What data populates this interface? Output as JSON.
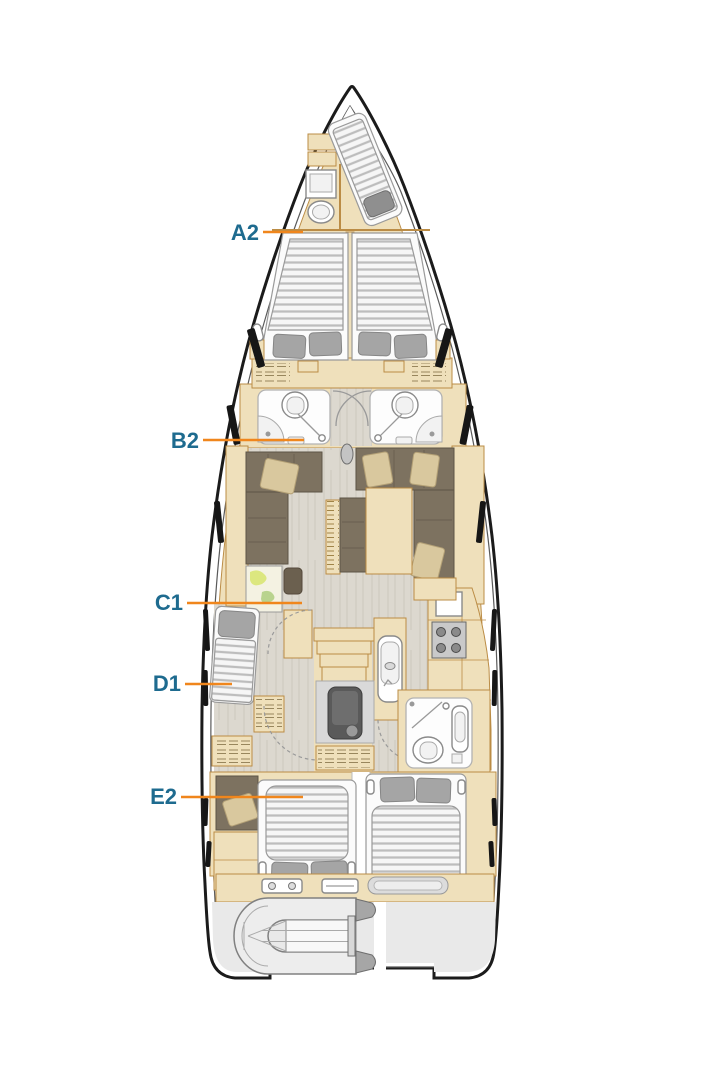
{
  "plan_labels": [
    {
      "text": "A2",
      "points_to": "bow-crew-cabin"
    },
    {
      "text": "B2",
      "points_to": "forward-port-bathroom"
    },
    {
      "text": "C1",
      "points_to": "salon"
    },
    {
      "text": "D1",
      "points_to": "port-single-berth"
    },
    {
      "text": "E2",
      "points_to": "aft-port-cabin"
    }
  ],
  "colors": {
    "label_text": "#1e6b8f",
    "leader_line": "#f0861c",
    "hull_line": "#1b1b1b",
    "tan": "#efe0bb",
    "tan_line": "#bb8c45",
    "floor_base": "#dcd8cf",
    "floor_grain": "#d0ccc3",
    "sofa": "#7d7260",
    "sofa_pillow": "#d9c89e",
    "mattress": "#f6f6f6",
    "mattress_stripe": "#bdbdbd",
    "pillow_gray": "#a5a5a5",
    "fixture_line": "#8a8a8a",
    "garage_gray": "#e9e9e9"
  }
}
